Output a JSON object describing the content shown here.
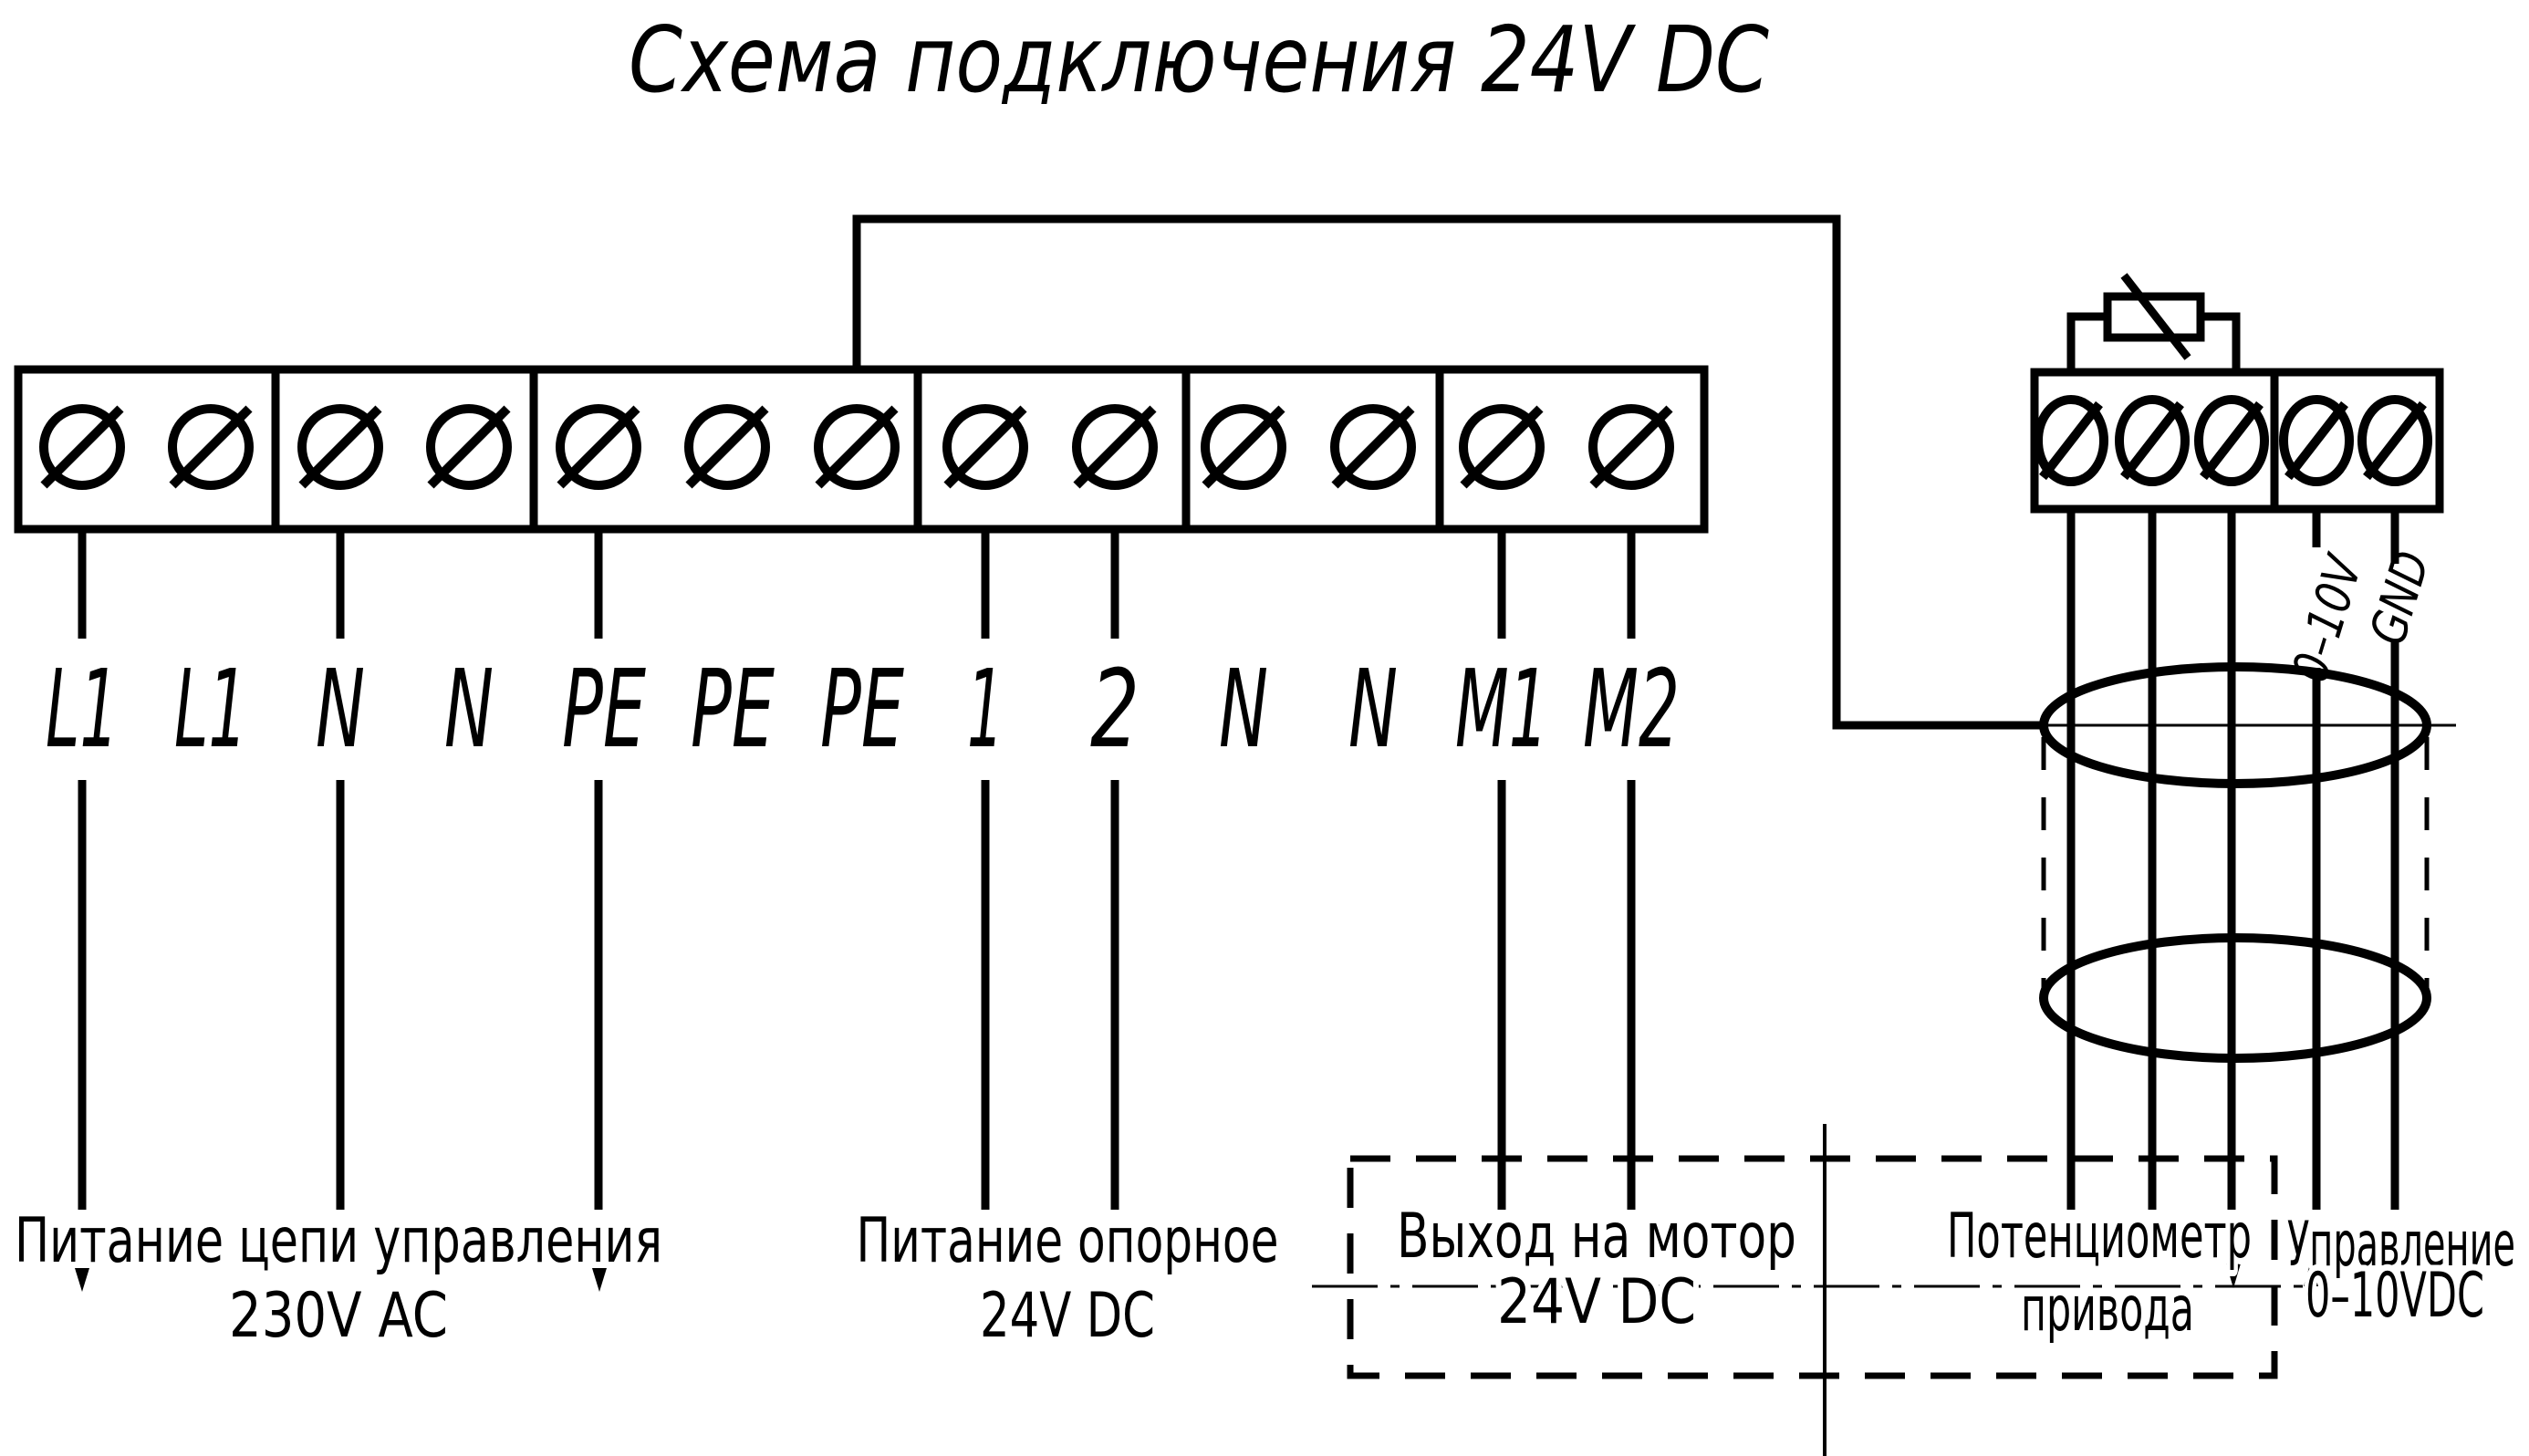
{
  "title": "Схема подключения 24V DC",
  "colors": {
    "ink": "#000000",
    "paper": "#ffffff"
  },
  "main_block": {
    "terminals": [
      "L1",
      "L1",
      "N",
      "N",
      "PE",
      "PE",
      "PE",
      "1",
      "2",
      "N",
      "N",
      "M1",
      "M2"
    ]
  },
  "actuator": {
    "wire_labels": [
      "0–10V",
      "GND"
    ]
  },
  "captions": {
    "mains": {
      "line1": "Питание цепи управления",
      "line2": "230V AC"
    },
    "reference": {
      "line1": "Питание опорное",
      "line2": "24V DC"
    },
    "motor": {
      "line1": "Выход на мотор",
      "line2": "24V DC"
    },
    "potentiometer": {
      "line1": "Потенциометр",
      "line2": "привода"
    },
    "control": {
      "line1": "Управление",
      "line2": "0–10VDC"
    }
  }
}
